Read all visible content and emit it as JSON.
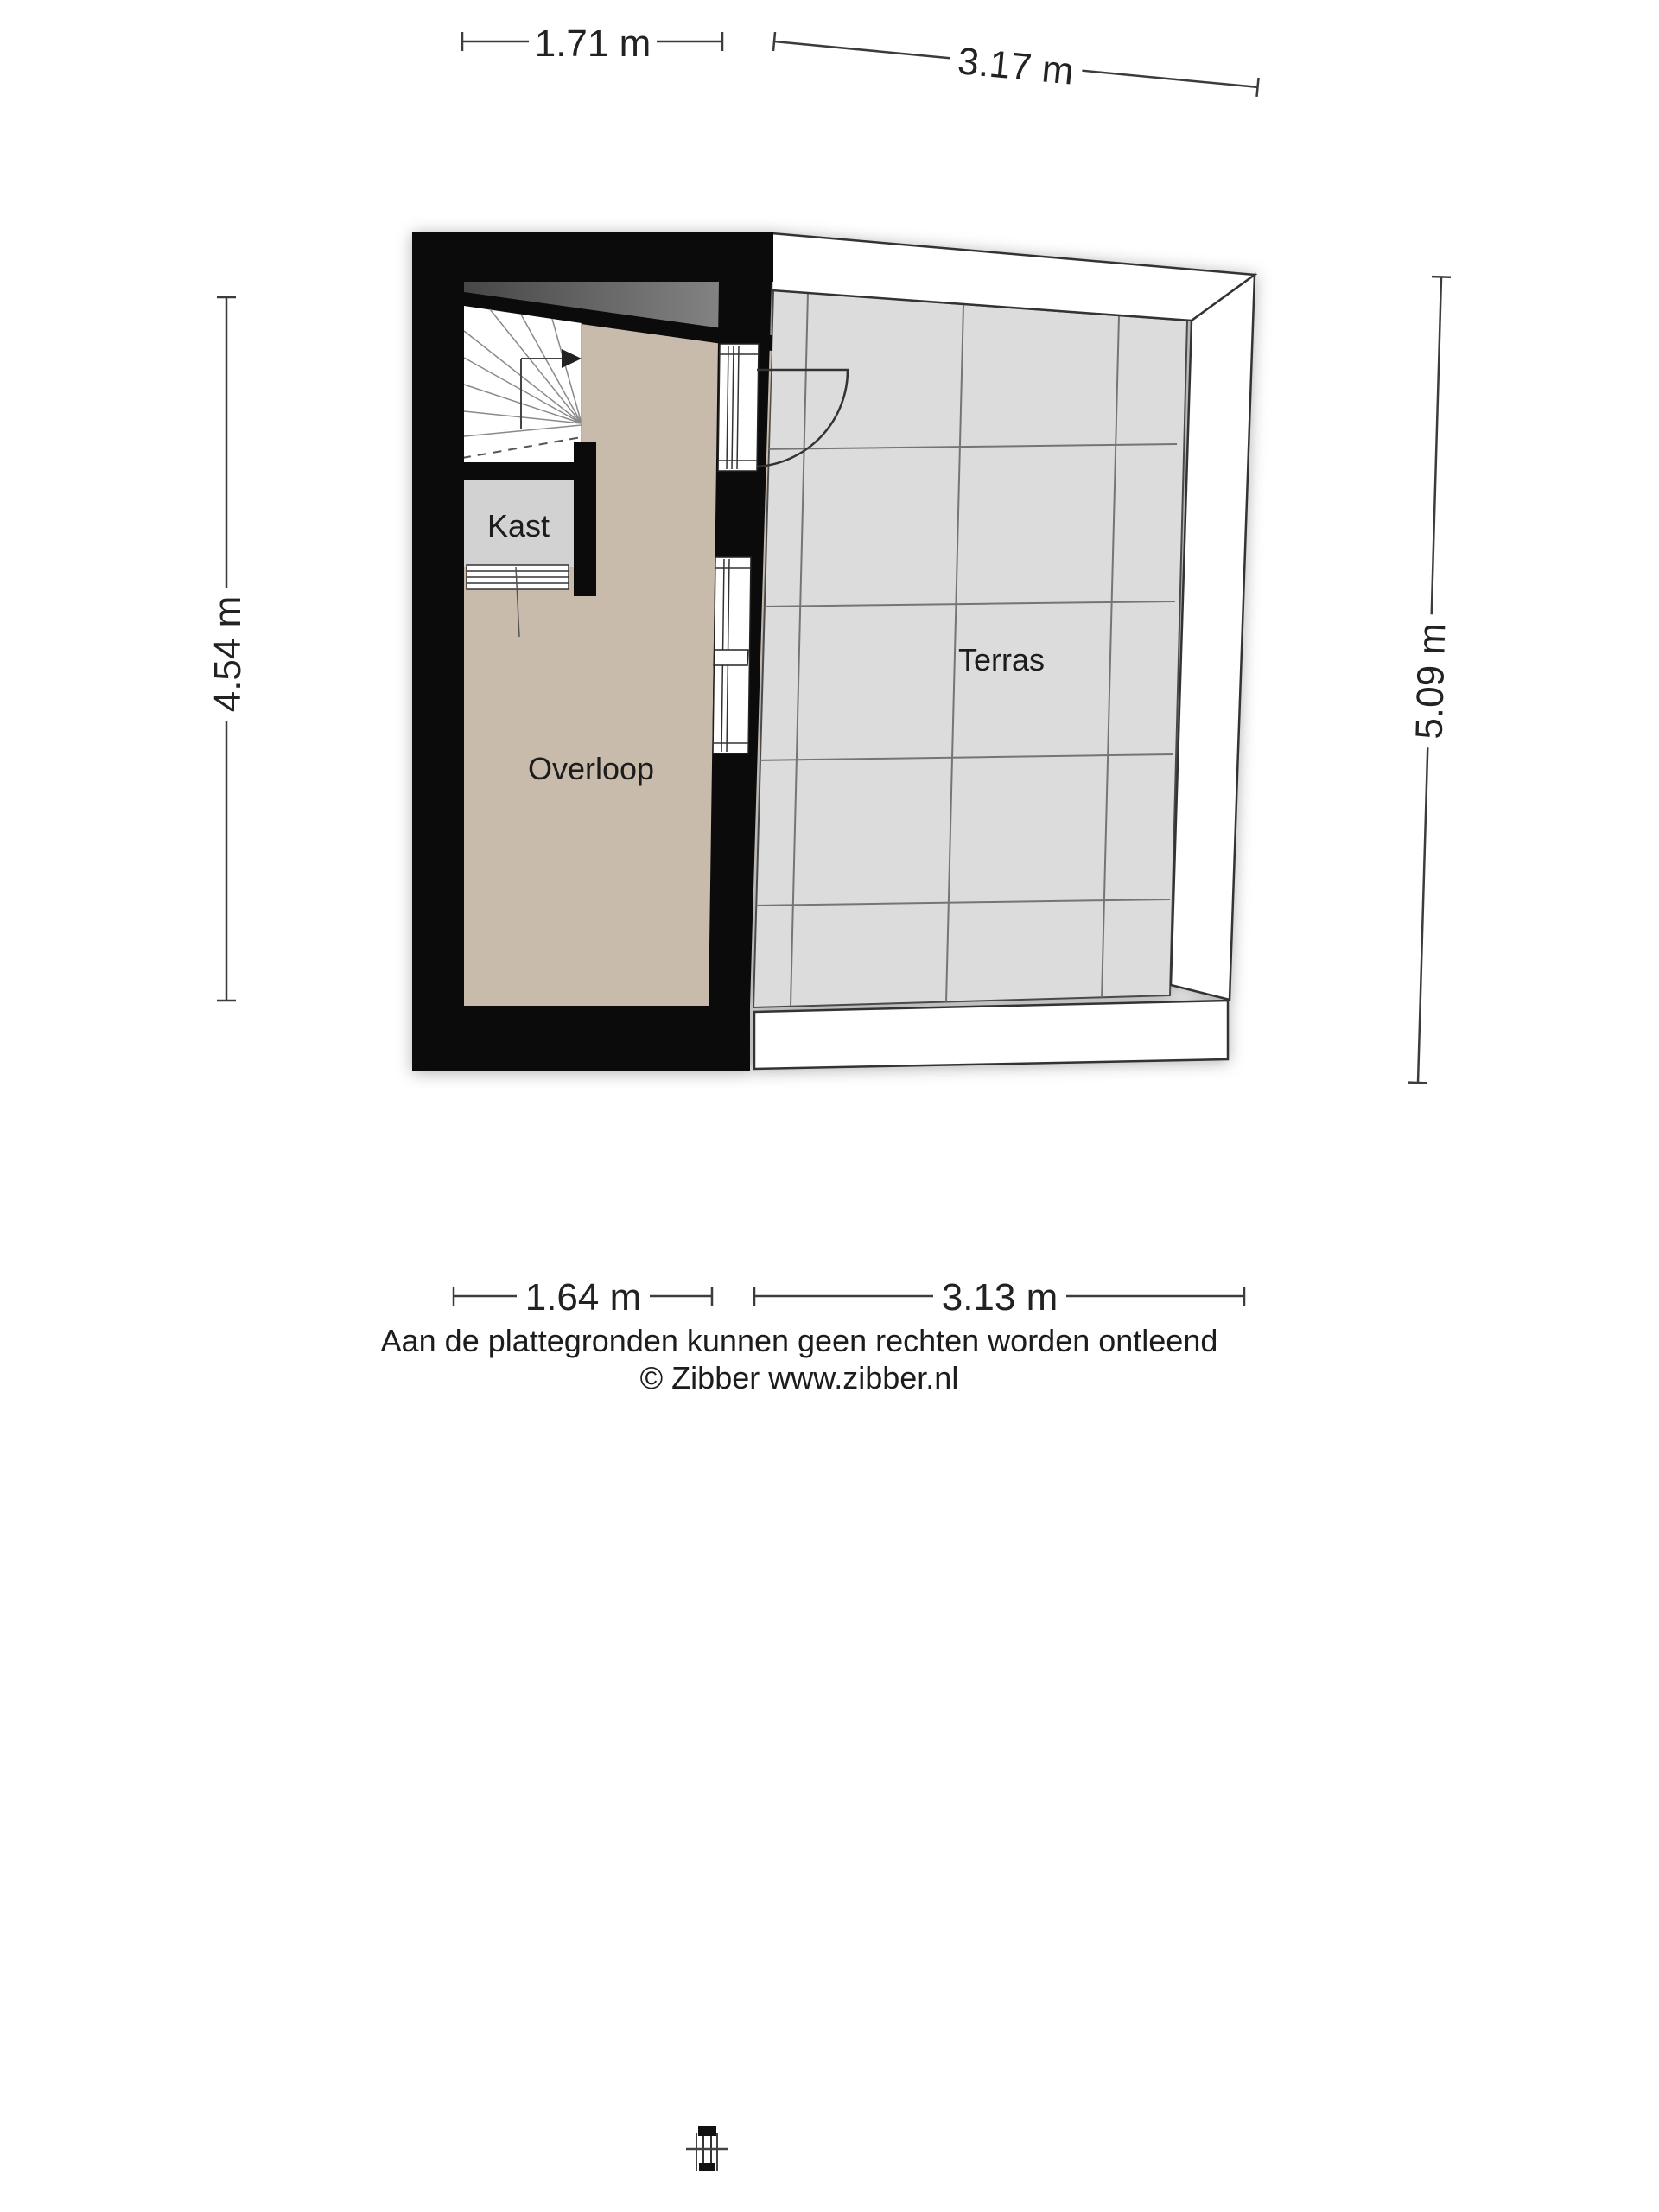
{
  "floorplan": {
    "rooms": [
      {
        "id": "kast",
        "label": "Kast"
      },
      {
        "id": "overloop",
        "label": "Overloop"
      },
      {
        "id": "terras",
        "label": "Terras"
      }
    ],
    "dimensions": {
      "top_overloop": "1.71 m",
      "top_terras": "3.17 m",
      "left": "4.54 m",
      "right": "5.09 m",
      "bottom_overloop": "1.64 m",
      "bottom_terras": "3.13 m"
    },
    "icons": {
      "stairs_direction": "arrow-right",
      "door_swing": "quarter-arc",
      "kast_door": "louvre-stripes"
    },
    "colors": {
      "wall": "#0b0b0b",
      "overloop_floor": "#c9bbab",
      "kast_floor": "#d2d2d2",
      "terras_floor": "#dcdcdd",
      "slope_dark": "#474747",
      "slope_light": "#8f8f8f",
      "tile_grid": "#757575",
      "outline": "#333333",
      "dimension_line": "#3c3c3c"
    }
  },
  "footer": {
    "disclaimer": "Aan de plattegronden kunnen geen rechten worden ontleend",
    "copyright": "© Zibber www.zibber.nl"
  }
}
